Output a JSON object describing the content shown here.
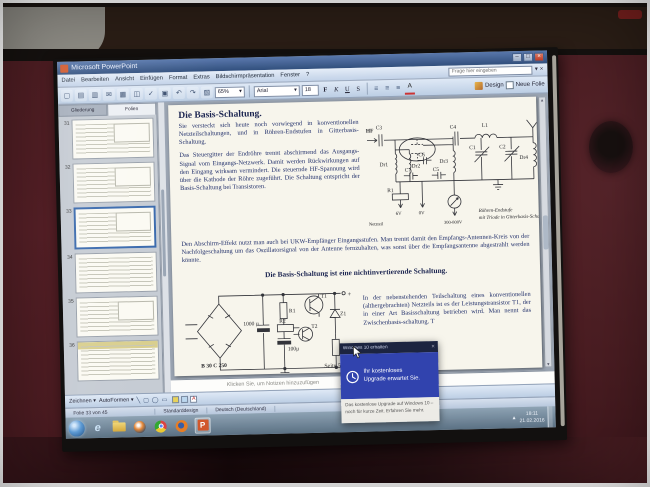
{
  "titlebar": {
    "title": "Microsoft PowerPoint",
    "minimize": "–",
    "maximize": "□",
    "close": "×"
  },
  "menubar": {
    "items": [
      "Datei",
      "Bearbeiten",
      "Ansicht",
      "Einfügen",
      "Format",
      "Extras",
      "Bildschirmpräsentation",
      "Fenster",
      "?"
    ],
    "question_placeholder": "Frage hier eingeben",
    "dropdown": "▾",
    "close": "×"
  },
  "toolbar": {
    "icons": [
      {
        "name": "new-file",
        "glyph": "▢"
      },
      {
        "name": "open-file",
        "glyph": "▤"
      },
      {
        "name": "save",
        "glyph": "▥"
      },
      {
        "name": "email",
        "glyph": "✉"
      },
      {
        "name": "print",
        "glyph": "▦"
      },
      {
        "name": "print-preview",
        "glyph": "◫"
      },
      {
        "name": "spelling",
        "glyph": "✓"
      },
      {
        "name": "copy",
        "glyph": "▣"
      },
      {
        "name": "undo",
        "glyph": "↶"
      },
      {
        "name": "redo",
        "glyph": "↷"
      },
      {
        "name": "insert-chart",
        "glyph": "▧"
      }
    ],
    "zoom_value": "65%",
    "font_name": "Arial",
    "font_size": "18",
    "format_buttons": [
      "F",
      "K",
      "U",
      "S"
    ],
    "align_glyph": "≡",
    "font_color_letter": "A",
    "design_label": "Design",
    "new_slide_label": "Neue Folie"
  },
  "sidebar": {
    "tabs": [
      "Gliederung",
      "Folien"
    ],
    "slides": [
      {
        "number": "31"
      },
      {
        "number": "32"
      },
      {
        "number": "33",
        "selected": true
      },
      {
        "number": "34"
      },
      {
        "number": "35"
      },
      {
        "number": "36"
      }
    ]
  },
  "slide": {
    "title": "Die Basis-Schaltung.",
    "para1": "Sie versteckt sich heute noch vorwiegend in konventionellen Netzteilschaltungen, und in Röhren-Endstufen in Gitterbasis-Schaltung.",
    "para2": "Das Steuergitter der Endröhre trennt abschirmend das Ausgangs-Signal vom Eingangs-Netzwerk. Damit werden Rückwirkungen auf den Eingang wirksam vermindert. Die steuernde HF-Spannung wird über die Kathode der Röhre zugeführt. Die Schaltung entspricht der Basis-Schaltung bei Transistoren.",
    "para3": "Den Abschirm-Effekt nutzt man auch bei UKW-Empfänger Eingangsstufen. Man trennt damit den Empfangs-Antennen-Kreis von der Nachfolgeschaltung um das Oszillatorsignal von der Antenne fernzuhalten, was sonst über die Empfangsantenne abgestrahlt werden könnte.",
    "statement": "Die Basis-Schaltung ist eine nichtinvertierende Schaltung.",
    "para4": "In der nebenstehenden Teilschaltung eines konventionellen (althergebrachten) Netzteils ist es der Leistungstransistor T1, der in einer Art Basisschaltung betrieben wird. Man nennt das Zwischenbasis-schaltung. T",
    "page_label": "Seite 5",
    "circuit1": {
      "caption1": "Röhren-Endstufe",
      "caption2": "mit Triode in Gitterbasis-Schaltung",
      "labels": {
        "hf": "HF",
        "c3": "C3",
        "dr1": "Dr1",
        "dr2": "Dr2",
        "dr3": "Dr3",
        "c4": "C4",
        "l1": "L1",
        "c1": "C1",
        "c2": "C2",
        "dr4": "Dr4",
        "c6": "C6",
        "c7": "C7",
        "c5": "C5",
        "r1": "R1",
        "v6": "6V",
        "v0": "0V",
        "vband": "300-800V",
        "netzteil": "Netzteil"
      }
    },
    "circuit2": {
      "labels": {
        "bridge": "B 30 C 250",
        "cap1": "1000 µ",
        "cap2": "100µ",
        "r1": "R1",
        "r2": "R2",
        "r3": "R3",
        "t1": "T1",
        "t2": "T2",
        "z1": "Z1",
        "plus": "+",
        "minus": "−"
      }
    }
  },
  "notes_placeholder": "Klicken Sie, um Notizen hinzuzufügen",
  "drawbar": {
    "draw_label": "Zeichnen",
    "autoshapes_label": "AutoFormen",
    "font_color_letter": "A"
  },
  "statusbar": {
    "slide_info": "Folie 33 von 45",
    "design_name": "Standarddesign",
    "language": "Deutsch (Deutschland)"
  },
  "taskbar": {
    "ie_letter": "e",
    "pp_letter": "P"
  },
  "tray": {
    "time": "18:11",
    "date": "21.02.2016"
  },
  "gwx": {
    "title": "Windows 10 erhalten",
    "close": "×",
    "headline1": "Ihr kostenloses",
    "headline2": "Upgrade erwartet Sie.",
    "body_line1": "Das kostenlose Upgrade auf Windows 10 –",
    "body_line2": "noch für kurze Zeit. Erfahren Sie mehr."
  },
  "glyphs": {
    "dropdown": "▾",
    "scroll_up": "▲",
    "scroll_down": "▼",
    "backslash": "╲",
    "circle": "◯",
    "rect": "▭",
    "square": "▢"
  },
  "colors": {
    "gwx_blue": "#3143ae",
    "gwx_titlebar": "#1c2440",
    "wall_maroon": "#4c1e22",
    "taskbar_blue": "#7d93a4",
    "slide_ink": "#22306b",
    "selection_blue": "#3a6aad"
  }
}
